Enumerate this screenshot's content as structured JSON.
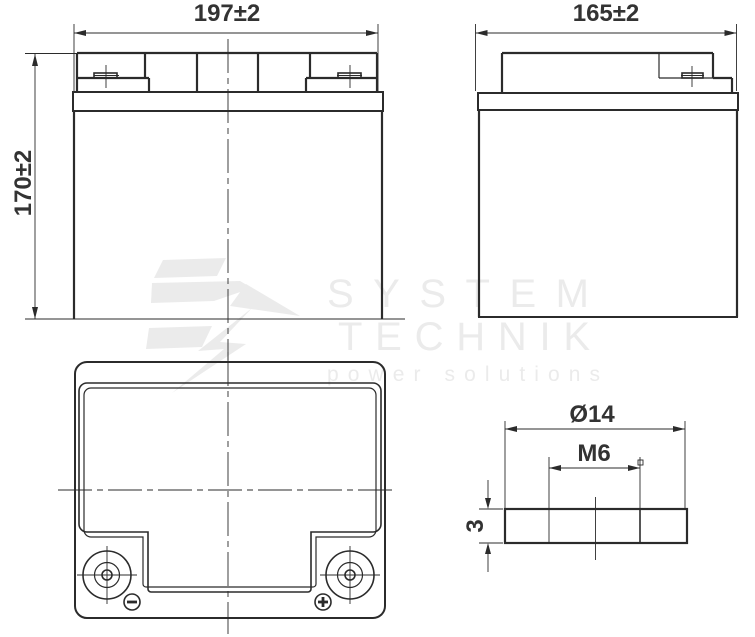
{
  "drawing": {
    "views": {
      "front": {
        "width_label": "197±2",
        "height_label": "170±2"
      },
      "side": {
        "depth_label": "165±2"
      },
      "terminal_detail": {
        "diameter_label": "Ø14",
        "thread_label": "M6",
        "thickness_label": "3"
      }
    },
    "terminals": {
      "negative_symbol": "−",
      "positive_symbol": "+"
    },
    "watermark": {
      "line1": "SYSTEM",
      "line2": "TECHNIK",
      "tagline": "power solutions"
    },
    "colors": {
      "line": "#2b2b2b",
      "watermark": "#ebebeb",
      "background": "#ffffff"
    }
  }
}
